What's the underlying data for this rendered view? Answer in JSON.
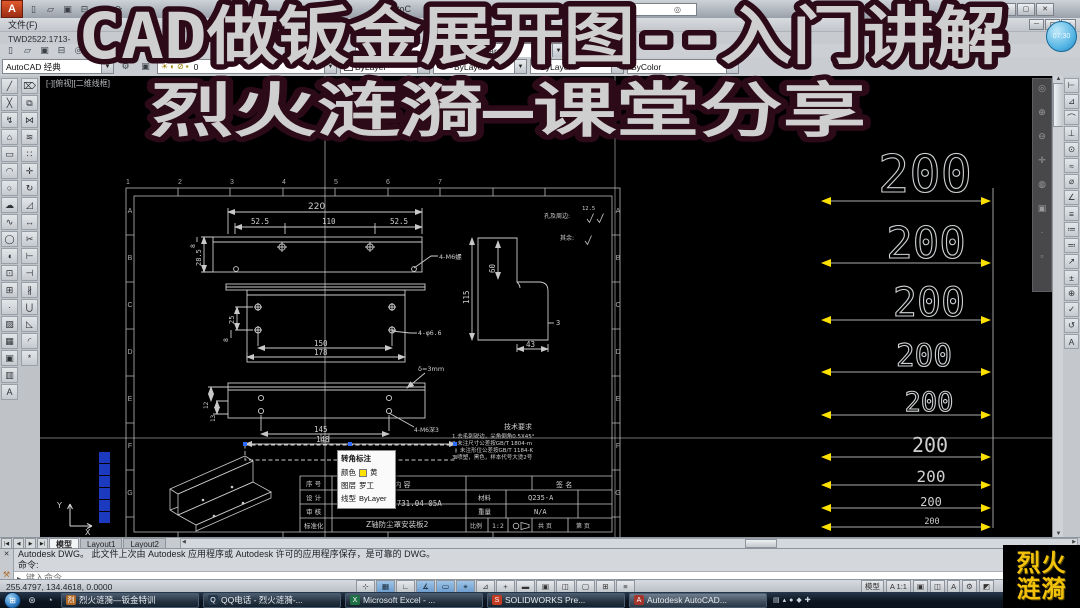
{
  "colors": {
    "overlay_purple": "#b724e0",
    "overlay_outline": "#2c0a18",
    "dim_arrow_yellow": "#ffe100",
    "cad_line": "#cdcdcd",
    "logo_yellow": "#f2c20a"
  },
  "window": {
    "title_fragment": "AutoC",
    "search_placeholder": "键入关键字",
    "timer": "07:30"
  },
  "menubar": {
    "file": "文件(F)"
  },
  "doc": {
    "name": "TWD2522.1713-"
  },
  "toolbars": {
    "workspace": "AutoCAD 经典",
    "layer_value": "0",
    "text_style": "Standard",
    "dim_style": "Standard",
    "color_value": "ByLayer",
    "linetype_value": "ByLayer",
    "lineweight_value": "ByLayer",
    "plotstyle_value": "ByColor"
  },
  "overlay": {
    "line1": "CAD做钣金展开图--入门讲解",
    "line2": "烈火涟漪—课堂分享"
  },
  "viewport_label": "[-][俯视][二维线框]",
  "drawing": {
    "zone_numbers": [
      "1",
      "2",
      "3",
      "4",
      "5",
      "6",
      "7"
    ],
    "zone_letters": [
      "A",
      "B",
      "C",
      "D",
      "E",
      "F",
      "G"
    ],
    "view1": {
      "dim_overall": "220",
      "dim_left": "52.5",
      "dim_mid": "110",
      "dim_right": "52.5",
      "dim_height": "28.5",
      "dim_edge": "8",
      "leader": "4-M6螺"
    },
    "view2": {
      "dim_h1": "25",
      "dim_h2": "8",
      "dim_w1": "150",
      "dim_w2": "178",
      "leader": "4-φ6.6"
    },
    "profile": {
      "dim_total": "115",
      "dim_upper": "60",
      "dim_width": "43",
      "dim_thk": "3"
    },
    "finish": {
      "label1": "孔及周边:",
      "value1": "12.5",
      "label2": "其余:"
    },
    "notes": {
      "title": "技术要求",
      "line1": "1.去毛刺锐边，尖角倒角0.5X45°",
      "line2": "2.未注尺寸公差按GB/T 1804-m",
      "line3": "未注形位公差按GB/T 1184-K",
      "line4": "3.喷塑，黑色，样本代号大烫2号"
    },
    "flat": {
      "dim_a": "12",
      "dim_b": "13",
      "dim_w1": "145",
      "dim_w2": "148",
      "leader1": "δ=3mm",
      "leader2": "4-M6深3"
    },
    "titleblock": {
      "row1": "序 号",
      "row2": "设 计",
      "row3": "审 核",
      "row4": "标准化",
      "header": "更 改 内 容",
      "part_no": "TWD2522-1731.04-05A",
      "part_name": "Z轴防尘罩安装板2",
      "material_label": "材料",
      "material": "Q235-A",
      "weight_label": "重量",
      "weight": "N/A",
      "scale_label": "比例",
      "scale": "1:2",
      "sign": "签 名",
      "pages_1": "共 页",
      "pages_2": "第 页"
    },
    "dims200": [
      "200",
      "200",
      "200",
      "200",
      "200",
      "200",
      "200",
      "200",
      "200"
    ]
  },
  "tooltip": {
    "title": "转角标注",
    "color_label": "颜色",
    "color_value": "黄",
    "layer_label": "图层",
    "layer_value": "罗工",
    "linetype_label": "线型",
    "linetype_value": "ByLayer"
  },
  "tabs": {
    "model": "模型",
    "layout1": "Layout1",
    "layout2": "Layout2"
  },
  "command": {
    "notice": "Autodesk DWG。  此文件上次由 Autodesk 应用程序或 Autodesk 许可的应用程序保存，是可靠的 DWG。",
    "prompt": "命令:",
    "placeholder": "键入命令"
  },
  "statusbar": {
    "coords": "255.4797, 134.4618, 0.0000",
    "model_label": "模型",
    "annotation_scale": "A 1:1"
  },
  "taskbar": {
    "buttons": [
      {
        "label": "烈火涟漪—钣金特训",
        "initial": "烈",
        "color": "#b06a28"
      },
      {
        "label": "QQ电话 - 烈火涟漪-...",
        "initial": "Q",
        "color": "#24364a"
      },
      {
        "label": "Microsoft Excel - ...",
        "initial": "X",
        "color": "#1e7145"
      },
      {
        "label": "SOLIDWORKS Pre...",
        "initial": "S",
        "color": "#c23b22"
      },
      {
        "label": "Autodesk AutoCAD...",
        "initial": "A",
        "color": "#a5342a"
      }
    ]
  },
  "logo": {
    "line1": "烈火",
    "line2": "涟漪"
  },
  "icons": {
    "qat": [
      {
        "name": "new-file-icon",
        "glyph": "▯"
      },
      {
        "name": "open-file-icon",
        "glyph": "▱"
      },
      {
        "name": "save-icon",
        "glyph": "▣"
      },
      {
        "name": "plot-icon",
        "glyph": "⊟"
      },
      {
        "name": "undo-icon",
        "glyph": "↶"
      },
      {
        "name": "redo-icon",
        "glyph": "↷"
      },
      {
        "name": "dropdown-icon",
        "glyph": "▾"
      }
    ],
    "std": [
      {
        "name": "new-file-icon",
        "glyph": "▯"
      },
      {
        "name": "open-file-icon",
        "glyph": "▱"
      },
      {
        "name": "save-icon",
        "glyph": "▣"
      },
      {
        "name": "plot-icon",
        "glyph": "⊟"
      },
      {
        "name": "plot-preview-icon",
        "glyph": "◎"
      },
      {
        "name": "cut-icon",
        "glyph": "✂"
      },
      {
        "name": "copy-icon",
        "glyph": "⧉"
      },
      {
        "name": "paste-icon",
        "glyph": "▤"
      },
      {
        "name": "undo-icon",
        "glyph": "↶"
      },
      {
        "name": "redo-icon",
        "glyph": "↷"
      },
      {
        "name": "pan-icon",
        "glyph": "✛"
      },
      {
        "name": "zoom-icon",
        "glyph": "⊕"
      },
      {
        "name": "properties-icon",
        "glyph": "▦"
      },
      {
        "name": "help-icon",
        "glyph": "?"
      }
    ],
    "layer": [
      {
        "name": "bulb-icon",
        "glyph": "☀"
      },
      {
        "name": "freeze-icon",
        "glyph": "◐"
      },
      {
        "name": "lock-icon",
        "glyph": "⊘"
      },
      {
        "name": "layer-color-icon",
        "glyph": "▪"
      }
    ],
    "draw": [
      {
        "name": "line-icon",
        "glyph": "╱"
      },
      {
        "name": "construction-line-icon",
        "glyph": "╳"
      },
      {
        "name": "polyline-icon",
        "glyph": "↯"
      },
      {
        "name": "polygon-icon",
        "glyph": "⌂"
      },
      {
        "name": "rectangle-icon",
        "glyph": "▭"
      },
      {
        "name": "arc-icon",
        "glyph": "◠"
      },
      {
        "name": "circle-icon",
        "glyph": "○"
      },
      {
        "name": "revcloud-icon",
        "glyph": "☁"
      },
      {
        "name": "spline-icon",
        "glyph": "∿"
      },
      {
        "name": "ellipse-icon",
        "glyph": "◯"
      },
      {
        "name": "ellipse-arc-icon",
        "glyph": "◖"
      },
      {
        "name": "insert-block-icon",
        "glyph": "⊡"
      },
      {
        "name": "make-block-icon",
        "glyph": "⊞"
      },
      {
        "name": "point-icon",
        "glyph": "∙"
      },
      {
        "name": "hatch-icon",
        "glyph": "▨"
      },
      {
        "name": "gradient-icon",
        "glyph": "▦"
      },
      {
        "name": "region-icon",
        "glyph": "▣"
      },
      {
        "name": "table-icon",
        "glyph": "▥"
      },
      {
        "name": "mtext-icon",
        "glyph": "A"
      }
    ],
    "modify": [
      {
        "name": "erase-icon",
        "glyph": "⌦"
      },
      {
        "name": "copy-icon",
        "glyph": "⧉"
      },
      {
        "name": "mirror-icon",
        "glyph": "⋈"
      },
      {
        "name": "offset-icon",
        "glyph": "≋"
      },
      {
        "name": "array-icon",
        "glyph": "∷"
      },
      {
        "name": "move-icon",
        "glyph": "✛"
      },
      {
        "name": "rotate-icon",
        "glyph": "↻"
      },
      {
        "name": "scale-icon",
        "glyph": "◿"
      },
      {
        "name": "stretch-icon",
        "glyph": "↔"
      },
      {
        "name": "trim-icon",
        "glyph": "✂"
      },
      {
        "name": "extend-icon",
        "glyph": "⊢"
      },
      {
        "name": "break-at-point-icon",
        "glyph": "⊣"
      },
      {
        "name": "break-icon",
        "glyph": "∦"
      },
      {
        "name": "join-icon",
        "glyph": "⋃"
      },
      {
        "name": "chamfer-icon",
        "glyph": "◺"
      },
      {
        "name": "fillet-icon",
        "glyph": "◜"
      },
      {
        "name": "explode-icon",
        "glyph": "*"
      }
    ],
    "dim": [
      {
        "name": "linear-dim-icon",
        "glyph": "⊢"
      },
      {
        "name": "aligned-dim-icon",
        "glyph": "⊿"
      },
      {
        "name": "arc-length-icon",
        "glyph": "⌒"
      },
      {
        "name": "ordinate-icon",
        "glyph": "⊥"
      },
      {
        "name": "radius-icon",
        "glyph": "⊙"
      },
      {
        "name": "jogged-icon",
        "glyph": "≈"
      },
      {
        "name": "diameter-icon",
        "glyph": "⌀"
      },
      {
        "name": "angular-icon",
        "glyph": "∠"
      },
      {
        "name": "quick-dim-icon",
        "glyph": "≡"
      },
      {
        "name": "baseline-icon",
        "glyph": "≔"
      },
      {
        "name": "continue-icon",
        "glyph": "≕"
      },
      {
        "name": "leader-icon",
        "glyph": "↗"
      },
      {
        "name": "tolerance-icon",
        "glyph": "±"
      },
      {
        "name": "center-mark-icon",
        "glyph": "⊕"
      },
      {
        "name": "inspection-icon",
        "glyph": "✓"
      },
      {
        "name": "dim-update-icon",
        "glyph": "↺"
      },
      {
        "name": "dim-text-icon",
        "glyph": "A"
      }
    ],
    "status_toggles": [
      {
        "name": "snap-toggle",
        "glyph": "⊹",
        "on": false
      },
      {
        "name": "grid-toggle",
        "glyph": "▦",
        "on": true
      },
      {
        "name": "ortho-toggle",
        "glyph": "∟",
        "on": false
      },
      {
        "name": "polar-toggle",
        "glyph": "∡",
        "on": true
      },
      {
        "name": "osnap-toggle",
        "glyph": "▭",
        "on": true
      },
      {
        "name": "otrack-toggle",
        "glyph": "⌖",
        "on": true
      },
      {
        "name": "ducs-toggle",
        "glyph": "⊿",
        "on": false
      },
      {
        "name": "dyn-toggle",
        "glyph": "+",
        "on": false
      },
      {
        "name": "lwt-toggle",
        "glyph": "▬",
        "on": false
      },
      {
        "name": "tpy-toggle",
        "glyph": "▣",
        "on": false
      },
      {
        "name": "qp-toggle",
        "glyph": "◫",
        "on": false
      },
      {
        "name": "sc-toggle",
        "glyph": "▢",
        "on": false
      },
      {
        "name": "am-toggle",
        "glyph": "⊞",
        "on": false
      },
      {
        "name": "model-toggle",
        "glyph": "≡",
        "on": false
      }
    ],
    "status_right": [
      {
        "name": "layout-icon",
        "glyph": "▣"
      },
      {
        "name": "preview-icon",
        "glyph": "◫"
      },
      {
        "name": "annotation-icon",
        "glyph": "A"
      },
      {
        "name": "settings-icon",
        "glyph": "⚙"
      },
      {
        "name": "cleanscreen-icon",
        "glyph": "◩"
      }
    ],
    "floatbar": [
      {
        "name": "navbar-compass-icon",
        "glyph": "◎"
      },
      {
        "name": "navbar-zoom-in-icon",
        "glyph": "⊕"
      },
      {
        "name": "navbar-zoom-out-icon",
        "glyph": "⊖"
      },
      {
        "name": "navbar-pan-icon",
        "glyph": "✛"
      },
      {
        "name": "navbar-orbit-icon",
        "glyph": "◍"
      },
      {
        "name": "navbar-steering-icon",
        "glyph": "▣"
      },
      {
        "name": "navbar-dot-icon",
        "glyph": "∙"
      },
      {
        "name": "navbar-more-icon",
        "glyph": "▫"
      }
    ],
    "tray": [
      {
        "name": "tray-grid-icon",
        "glyph": "▤"
      },
      {
        "name": "tray-up-icon",
        "glyph": "▴"
      },
      {
        "name": "tray-green-icon",
        "glyph": "●"
      },
      {
        "name": "tray-qq-icon",
        "glyph": "◆"
      },
      {
        "name": "tray-shield-icon",
        "glyph": "✚"
      }
    ]
  }
}
